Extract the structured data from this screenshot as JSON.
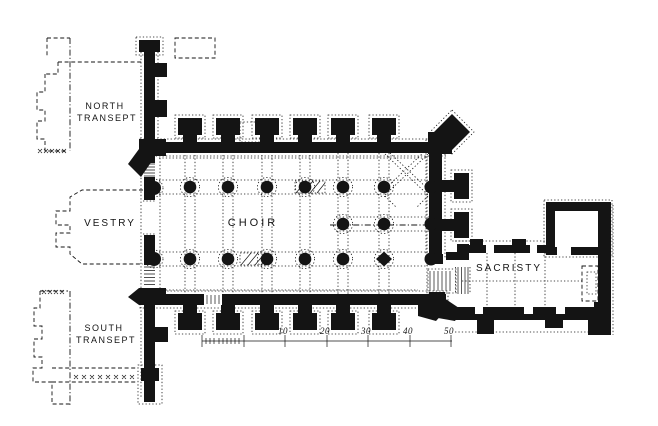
{
  "rooms": {
    "north_transept": {
      "line1": "NORTH",
      "line2": "TRANSEPT"
    },
    "vestry": {
      "label": "VESTRY"
    },
    "choir": {
      "label": "CHOIR"
    },
    "south_transept": {
      "line1": "SOUTH",
      "line2": "TRANSEPT"
    },
    "sacristy": {
      "label": "SACRISTY"
    }
  },
  "scale_bar": {
    "labels": [
      "10",
      "20",
      "30",
      "40",
      "50"
    ]
  },
  "colors": {
    "ink": "#141414",
    "paper": "#ffffff"
  }
}
